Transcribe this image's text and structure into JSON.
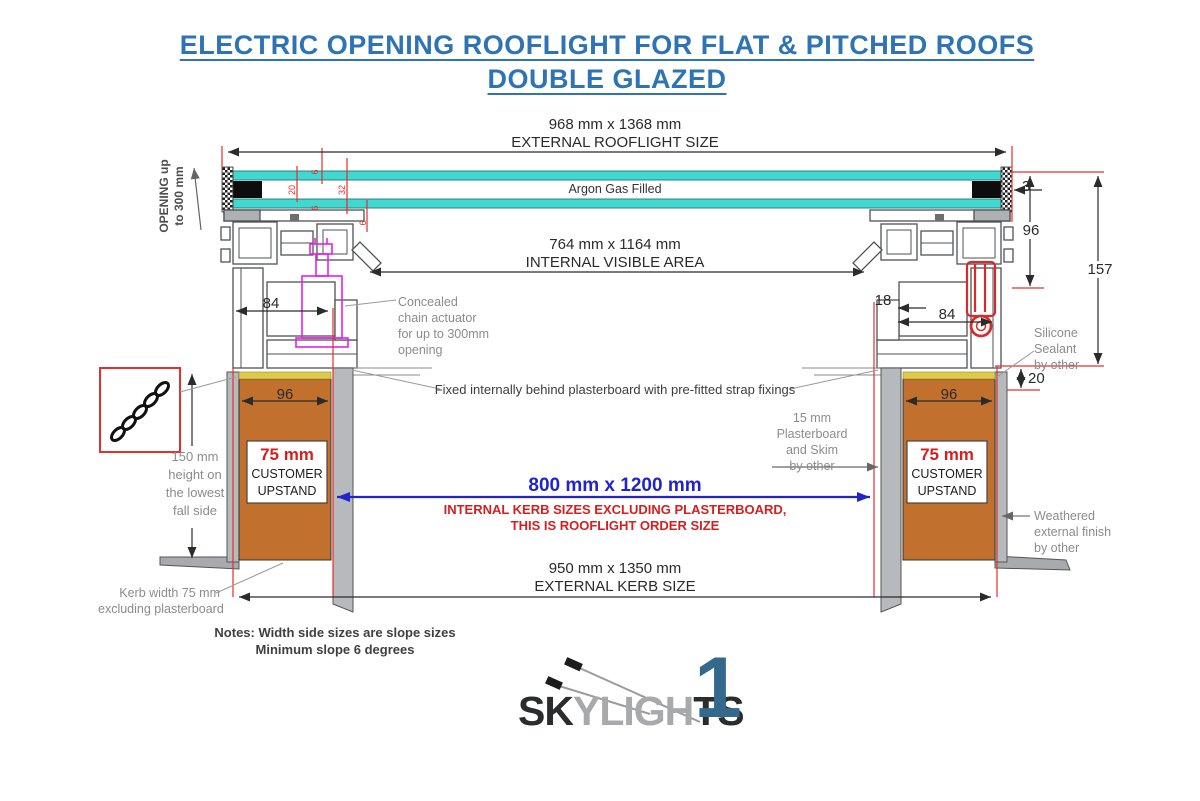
{
  "title": {
    "line1": "ELECTRIC OPENING ROOFLIGHT FOR FLAT & PITCHED ROOFS",
    "line2": "DOUBLE GLAZED"
  },
  "dimensions": {
    "external_rooflight": {
      "size": "968 mm x 1368 mm",
      "label": "EXTERNAL ROOFLIGHT SIZE"
    },
    "internal_visible": {
      "size": "764 mm x 1164 mm",
      "label": "INTERNAL VISIBLE AREA"
    },
    "internal_kerb": {
      "size": "800 mm x 1200 mm",
      "note1": "INTERNAL KERB SIZES EXCLUDING PLASTERBOARD,",
      "note2": "THIS IS ROOFLIGHT ORDER SIZE"
    },
    "external_kerb": {
      "size": "950 mm x 1350 mm",
      "label": "EXTERNAL KERB SIZE"
    },
    "glass_outer_pane": "6",
    "glass_cavity": "20",
    "glass_unit": "32",
    "glass_inner_pane": "6",
    "glass_edge": "6",
    "frame_left_width": "84",
    "frame_right_offset": "18",
    "frame_right_width": "84",
    "edge_clearance": "3",
    "frame_height": "96",
    "overall_height": "157",
    "sealant_gap": "20",
    "kerb_left_width": "96",
    "kerb_right_width": "96"
  },
  "annotations": {
    "opening": {
      "line1": "OPENING up",
      "line2": "to 300 mm"
    },
    "argon": "Argon Gas Filled",
    "actuator": [
      "Concealed",
      "chain actuator",
      "for up to 300mm",
      "opening"
    ],
    "fixed": "Fixed internally behind plasterboard with pre-fitted strap fixings",
    "silicone": [
      "Silicone",
      "Sealant",
      "by other"
    ],
    "plasterboard": [
      "15 mm",
      "Plasterboard",
      "and Skim",
      "by other"
    ],
    "upstand": {
      "size": "75 mm",
      "line1": "CUSTOMER",
      "line2": "UPSTAND"
    },
    "fall_height": [
      "150 mm",
      "height on",
      "the lowest",
      "fall side"
    ],
    "kerb_width": [
      "Kerb width 75 mm",
      "excluding plasterboard"
    ],
    "weathered": [
      "Weathered",
      "external finish",
      "by other"
    ],
    "notes": {
      "line1": "Notes: Width side sizes are slope sizes",
      "line2": "Minimum slope 6 degrees"
    }
  },
  "logo": {
    "part1": "SK",
    "part2": "YLIGH",
    "part3": "TS",
    "numeral": "1"
  },
  "colors": {
    "title_blue": "#2e74b5",
    "dimension_red": "#e03030",
    "order_blue": "#2323cc",
    "warning_red": "#d42020",
    "glass_cyan": "#3fd9d2",
    "kerb_orange": "#c1702e",
    "sealant_yellow": "#ddc94a",
    "actuator_magenta": "#e522e5",
    "logo_blue": "#34688c",
    "annotation_gray": "#8c8c8c"
  }
}
